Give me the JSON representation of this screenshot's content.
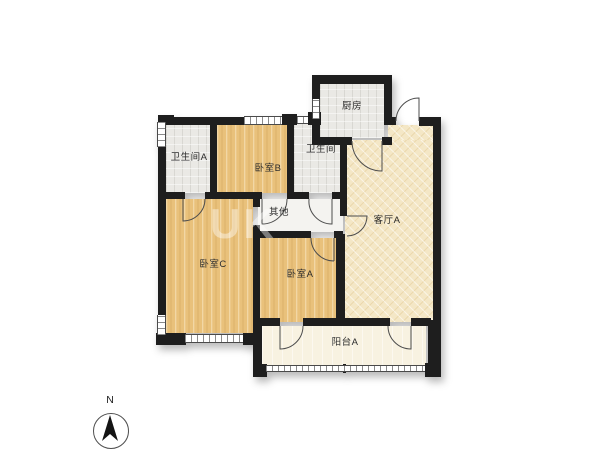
{
  "floor_plan": {
    "rooms": {
      "bathroom_a": {
        "label": "卫生间A"
      },
      "bedroom_b": {
        "label": "卧室B"
      },
      "bathroom": {
        "label": "卫生间"
      },
      "kitchen": {
        "label": "厨房"
      },
      "living_room_a": {
        "label": "客厅A"
      },
      "other": {
        "label": "其他"
      },
      "bedroom_c": {
        "label": "卧室C"
      },
      "bedroom_a": {
        "label": "卧室A"
      },
      "balcony_a": {
        "label": "阳台A"
      }
    },
    "compass": {
      "north_label": "N"
    },
    "watermark": {
      "text": "UK"
    },
    "colors": {
      "wall": "#1e1e1e",
      "bedroom_floor": "#e9c17b",
      "living_floor": "#f4e7c6",
      "wet_room_floor": "#eae9e5",
      "balcony_floor": "#f8f2e1",
      "background": "#ffffff"
    }
  }
}
